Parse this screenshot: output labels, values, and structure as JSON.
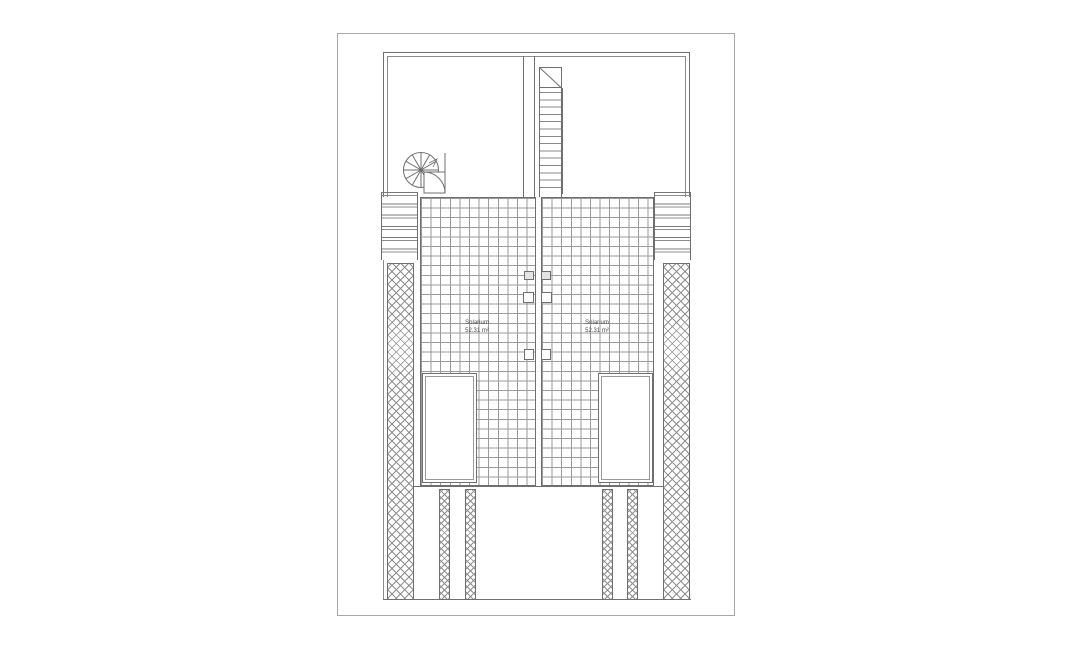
{
  "sheet": {
    "background": "#ffffff",
    "border_color": "#a9a9a9",
    "line_color": "#6f6f6f",
    "tile_grid_color": "#9a9a9a",
    "hatch_color": "#8f8f8f"
  },
  "plan": {
    "type": "roof-terrace-floor-plan",
    "units": {
      "left": {
        "label": "Solarium",
        "area": "52.31 m²"
      },
      "right": {
        "label": "Solarium",
        "area": "52.31 m²"
      }
    },
    "features": [
      "spiral-staircase",
      "straight-staircase",
      "railings",
      "herringbone-side-walls",
      "tiled-decks",
      "roof-openings",
      "vent-squares",
      "lower-beams"
    ]
  }
}
